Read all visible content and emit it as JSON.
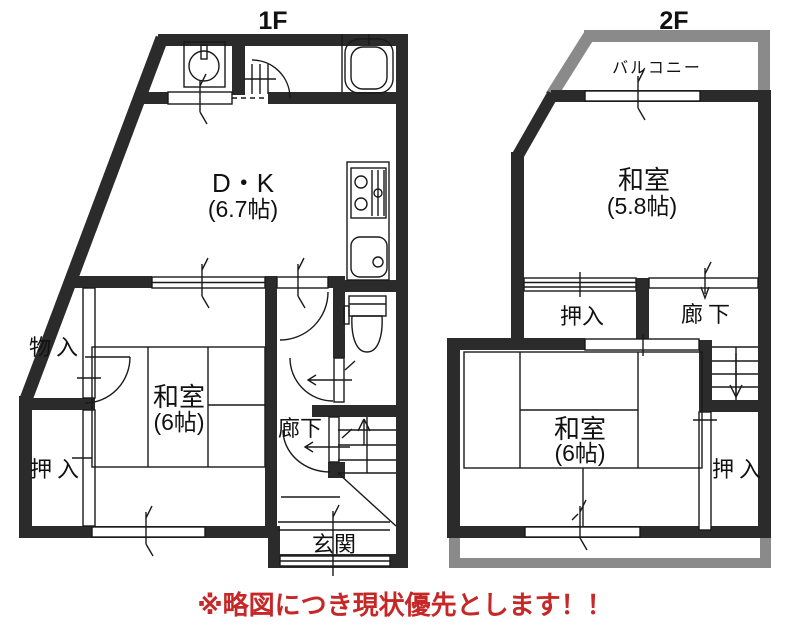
{
  "floor1": {
    "title": "1F",
    "rooms": {
      "dk": {
        "name": "D・K",
        "size": "(6.7帖)"
      },
      "washitsu": {
        "name": "和室",
        "size": "(6帖)"
      },
      "monoire": {
        "label": "物入"
      },
      "oshiire": {
        "label": "押入"
      },
      "rouka": {
        "label": "廊下"
      },
      "genkan": {
        "label": "玄関"
      }
    }
  },
  "floor2": {
    "title": "2F",
    "rooms": {
      "balcony": {
        "label": "バルコニー"
      },
      "washitsu_a": {
        "name": "和室",
        "size": "(5.8帖)"
      },
      "oshiire_upper": {
        "label": "押入"
      },
      "rouka": {
        "label": "廊下"
      },
      "washitsu_b": {
        "name": "和室",
        "size": "(6帖)"
      },
      "oshiire_lower": {
        "label": "押入"
      }
    }
  },
  "note": {
    "text": "※略図につき現状優先とします！！"
  },
  "colors": {
    "wall": "#2b2b2b",
    "line": "#1a1a1a",
    "balcony": "#8a8a8a",
    "note": "#c62828",
    "bg": "#ffffff"
  }
}
